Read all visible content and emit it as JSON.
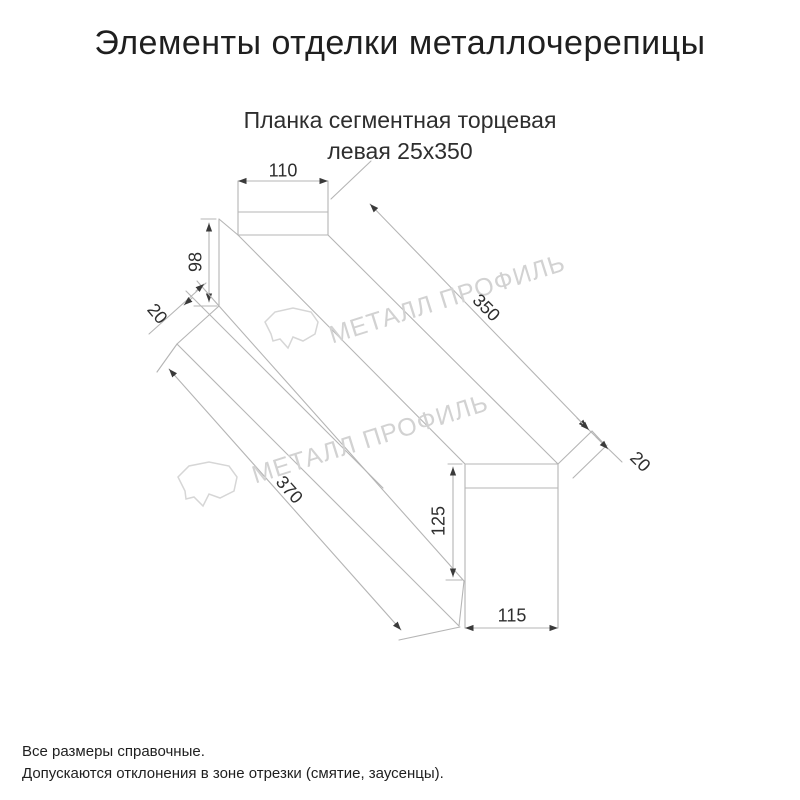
{
  "title": "Элементы отделки металлочерепицы",
  "subtitle": {
    "line1": "Планка сегментная торцевая",
    "line2": "левая 25x350"
  },
  "drawing": {
    "name": "Планка сегментная торцевая левая",
    "dimensions": {
      "top_flange_width": "110",
      "left_end_height": "98",
      "left_hem": "20",
      "length_top_edge": "350",
      "length_bottom_edge": "370",
      "right_face_height": "125",
      "right_hem": "20",
      "bottom_width": "115"
    }
  },
  "watermark": {
    "text": "МЕТАЛЛ ПРОФИЛЬ",
    "logo": "cloud-stone-logo"
  },
  "footnotes": {
    "line1": "Все размеры справочные.",
    "line2": "Допускаются отклонения в зоне отрезки (смятие, заусенцы)."
  },
  "colors": {
    "background": "#ffffff",
    "line": "#b5b5b5",
    "arrow": "#3a3a3a",
    "title_text": "#1f1f1f",
    "dim_text": "#2e2e2e",
    "watermark": "#d2d2d2"
  }
}
